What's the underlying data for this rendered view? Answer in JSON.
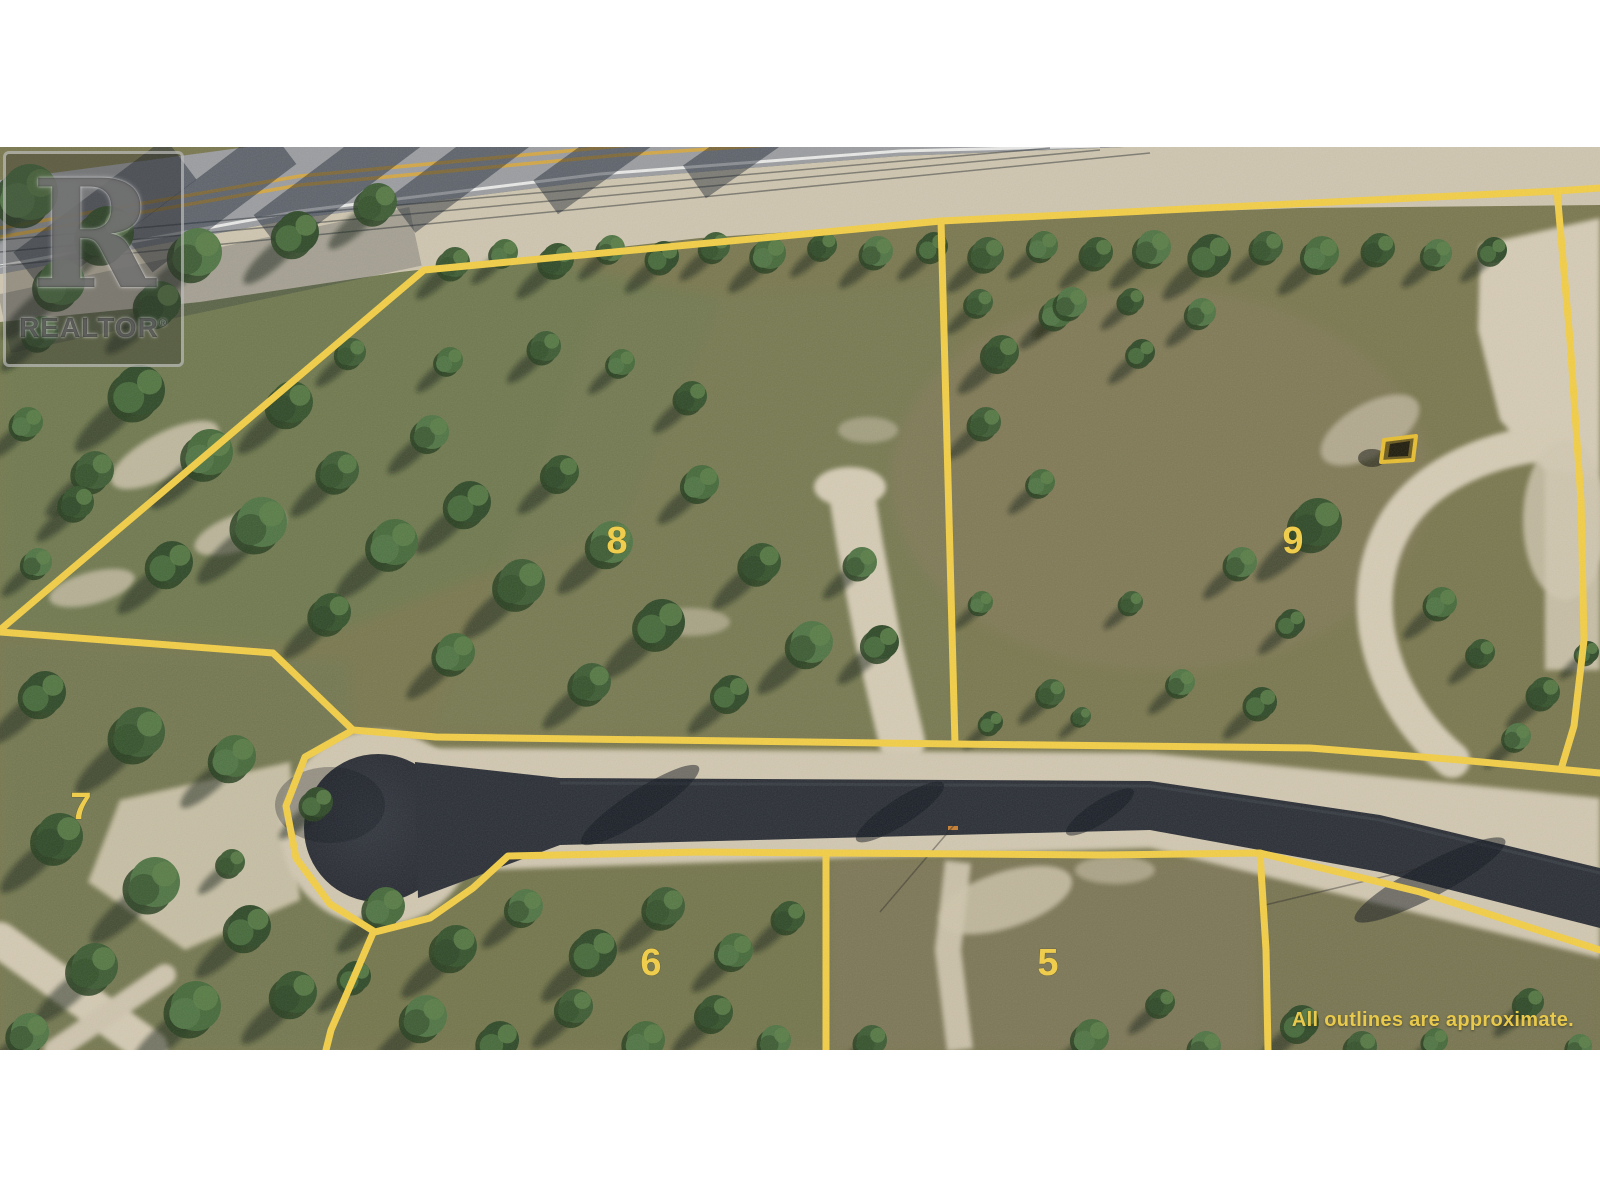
{
  "watermark": {
    "letter": "R",
    "brand": "REALTOR",
    "reg": "®"
  },
  "disclaimer": "All outlines are approximate.",
  "lots": [
    {
      "number": "7",
      "x": 81,
      "y": 806
    },
    {
      "number": "8",
      "x": 617,
      "y": 540
    },
    {
      "number": "9",
      "x": 1293,
      "y": 540
    },
    {
      "number": "6",
      "x": 651,
      "y": 962
    },
    {
      "number": "5",
      "x": 1048,
      "y": 962
    }
  ],
  "boundaries": [
    {
      "name": "lot8-lot9-north-line",
      "points": "0,630 424,270 941,221 1557,191 1600,188"
    },
    {
      "name": "divider-lot8-lot9",
      "points": "941,221 948,480 955,744"
    },
    {
      "name": "lot9-east-line",
      "points": "1557,191 1570,340 1581,500 1584,640 1574,726 1562,766"
    },
    {
      "name": "divider-lot7-lot8",
      "points": "0,632 273,653 353,730"
    },
    {
      "name": "road-north-line",
      "points": "353,730 436,737 955,744 1310,748 1460,760 1600,773"
    },
    {
      "name": "road-south-culdesac",
      "points": "353,730 305,757 286,806 296,858 330,904 375,932 430,918 473,888 508,856 700,852 1100,855 1260,853 1420,892 1600,950"
    },
    {
      "name": "divider-lot7-lot6",
      "points": "373,933 351,984 331,1030 326,1050"
    },
    {
      "name": "divider-lot6-lot5",
      "points": "826,854 826,1050"
    },
    {
      "name": "divider-lot5-east",
      "points": "1260,853 1266,950 1268,1050"
    }
  ],
  "colors": {
    "outline": "#F3CE45",
    "label": "#F3CE45",
    "disclaimer": "#E8C94C",
    "highway_centerline": "#D9A83C",
    "marker_outline": "#E8BE30"
  }
}
